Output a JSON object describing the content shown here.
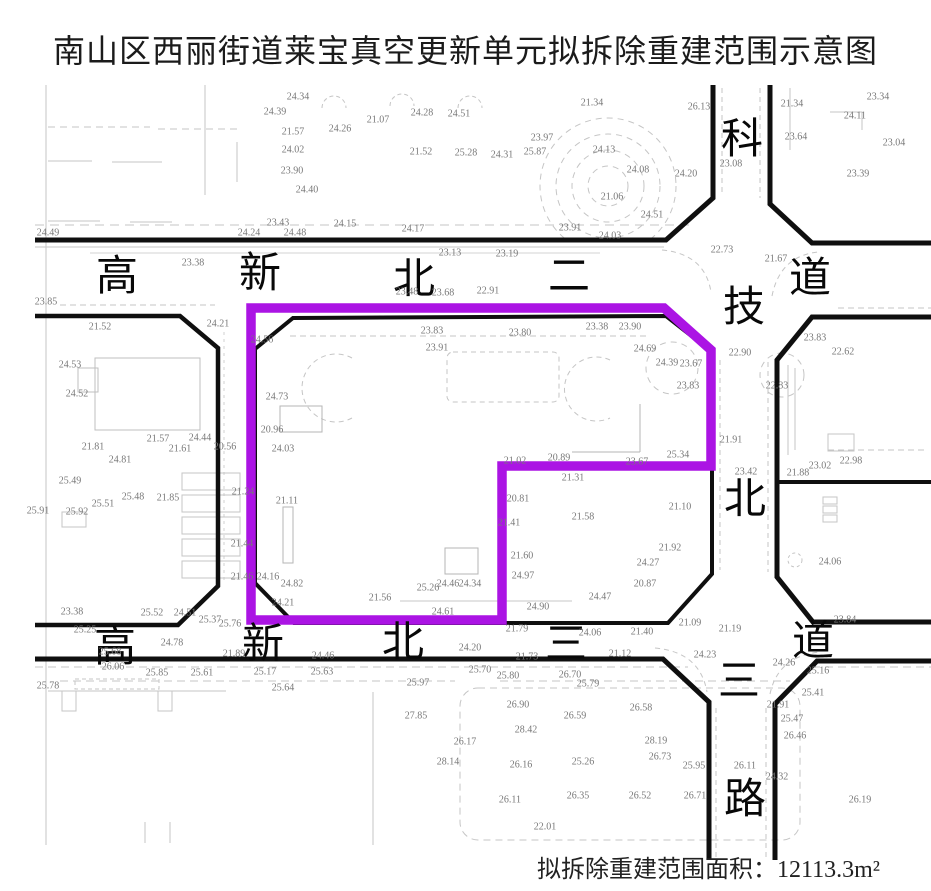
{
  "title": "南山区西丽街道莱宝真空更新单元拟拆除重建范围示意图",
  "footer": {
    "label": "拟拆除重建范围面积：",
    "value": "12113.3m²"
  },
  "colors": {
    "boundary": "#AB14E4",
    "road_line": "#0f0f0f",
    "detail_line": "#c5c5c5",
    "elevation_text": "#787878"
  },
  "roads": {
    "north_road": {
      "name": "高新北二道",
      "orientation": "horizontal",
      "chars": [
        {
          "c": "高",
          "x": 117,
          "y": 277
        },
        {
          "c": "新",
          "x": 260,
          "y": 274
        },
        {
          "c": "北",
          "x": 414,
          "y": 280
        },
        {
          "c": "二",
          "x": 569,
          "y": 277
        },
        {
          "c": "道",
          "x": 810,
          "y": 279
        }
      ]
    },
    "south_road": {
      "name": "高新北三道",
      "orientation": "horizontal",
      "chars": [
        {
          "c": "高",
          "x": 115,
          "y": 648
        },
        {
          "c": "新",
          "x": 263,
          "y": 645
        },
        {
          "c": "北",
          "x": 403,
          "y": 643
        },
        {
          "c": "三",
          "x": 566,
          "y": 645
        },
        {
          "c": "道",
          "x": 813,
          "y": 642
        }
      ]
    },
    "east_road": {
      "name": "科技北三路",
      "orientation": "vertical",
      "chars": [
        {
          "c": "科",
          "x": 742,
          "y": 140
        },
        {
          "c": "技",
          "x": 744,
          "y": 308
        },
        {
          "c": "北",
          "x": 745,
          "y": 500
        },
        {
          "c": "三",
          "x": 739,
          "y": 682
        },
        {
          "c": "路",
          "x": 745,
          "y": 800
        }
      ]
    }
  },
  "boundary": {
    "meaning": "拟拆除重建范围",
    "area": "12113.3m²"
  },
  "spot_elevations": [
    {
      "x": 48,
      "y": 233,
      "v": "24.49"
    },
    {
      "x": 249,
      "y": 233,
      "v": "24.24"
    },
    {
      "x": 295,
      "y": 233,
      "v": "24.48"
    },
    {
      "x": 413,
      "y": 229,
      "v": "24.17"
    },
    {
      "x": 345,
      "y": 224,
      "v": "24.15"
    },
    {
      "x": 278,
      "y": 223,
      "v": "23.43"
    },
    {
      "x": 298,
      "y": 97,
      "v": "24.34"
    },
    {
      "x": 275,
      "y": 112,
      "v": "24.39"
    },
    {
      "x": 422,
      "y": 113,
      "v": "24.28"
    },
    {
      "x": 459,
      "y": 114,
      "v": "24.51"
    },
    {
      "x": 378,
      "y": 120,
      "v": "21.07"
    },
    {
      "x": 293,
      "y": 132,
      "v": "21.57"
    },
    {
      "x": 340,
      "y": 129,
      "v": "24.26"
    },
    {
      "x": 293,
      "y": 150,
      "v": "24.02"
    },
    {
      "x": 421,
      "y": 152,
      "v": "21.52"
    },
    {
      "x": 466,
      "y": 153,
      "v": "25.28"
    },
    {
      "x": 292,
      "y": 171,
      "v": "23.90"
    },
    {
      "x": 307,
      "y": 190,
      "v": "24.40"
    },
    {
      "x": 592,
      "y": 103,
      "v": "21.34"
    },
    {
      "x": 542,
      "y": 138,
      "v": "23.97"
    },
    {
      "x": 502,
      "y": 155,
      "v": "24.31"
    },
    {
      "x": 535,
      "y": 152,
      "v": "25.87"
    },
    {
      "x": 604,
      "y": 150,
      "v": "24.13"
    },
    {
      "x": 638,
      "y": 170,
      "v": "24.08"
    },
    {
      "x": 686,
      "y": 174,
      "v": "24.20"
    },
    {
      "x": 612,
      "y": 197,
      "v": "21.06"
    },
    {
      "x": 652,
      "y": 215,
      "v": "24.51"
    },
    {
      "x": 570,
      "y": 228,
      "v": "23.91"
    },
    {
      "x": 610,
      "y": 236,
      "v": "24.03"
    },
    {
      "x": 699,
      "y": 107,
      "v": "26.13"
    },
    {
      "x": 792,
      "y": 104,
      "v": "21.34"
    },
    {
      "x": 855,
      "y": 116,
      "v": "24.11"
    },
    {
      "x": 858,
      "y": 174,
      "v": "23.39"
    },
    {
      "x": 878,
      "y": 97,
      "v": "23.34"
    },
    {
      "x": 894,
      "y": 143,
      "v": "23.04"
    },
    {
      "x": 796,
      "y": 137,
      "v": "23.64"
    },
    {
      "x": 731,
      "y": 164,
      "v": "23.08"
    },
    {
      "x": 193,
      "y": 263,
      "v": "23.38"
    },
    {
      "x": 450,
      "y": 253,
      "v": "23.13"
    },
    {
      "x": 507,
      "y": 254,
      "v": "23.19"
    },
    {
      "x": 722,
      "y": 250,
      "v": "22.73"
    },
    {
      "x": 407,
      "y": 292,
      "v": "23.48"
    },
    {
      "x": 443,
      "y": 293,
      "v": "23.68"
    },
    {
      "x": 488,
      "y": 291,
      "v": "22.91"
    },
    {
      "x": 46,
      "y": 302,
      "v": "23.85"
    },
    {
      "x": 776,
      "y": 259,
      "v": "21.67"
    },
    {
      "x": 843,
      "y": 352,
      "v": "22.62"
    },
    {
      "x": 815,
      "y": 338,
      "v": "23.83"
    },
    {
      "x": 740,
      "y": 353,
      "v": "22.90"
    },
    {
      "x": 777,
      "y": 386,
      "v": "22.83"
    },
    {
      "x": 851,
      "y": 461,
      "v": "22.98"
    },
    {
      "x": 820,
      "y": 466,
      "v": "23.02"
    },
    {
      "x": 798,
      "y": 473,
      "v": "21.88"
    },
    {
      "x": 731,
      "y": 440,
      "v": "21.91"
    },
    {
      "x": 746,
      "y": 472,
      "v": "23.42"
    },
    {
      "x": 830,
      "y": 562,
      "v": "24.06"
    },
    {
      "x": 845,
      "y": 620,
      "v": "23.84"
    },
    {
      "x": 100,
      "y": 327,
      "v": "21.52"
    },
    {
      "x": 218,
      "y": 324,
      "v": "24.21"
    },
    {
      "x": 262,
      "y": 340,
      "v": "24.56"
    },
    {
      "x": 432,
      "y": 331,
      "v": "23.83"
    },
    {
      "x": 437,
      "y": 348,
      "v": "23.91"
    },
    {
      "x": 520,
      "y": 333,
      "v": "23.80"
    },
    {
      "x": 597,
      "y": 327,
      "v": "23.38"
    },
    {
      "x": 630,
      "y": 327,
      "v": "23.90"
    },
    {
      "x": 645,
      "y": 349,
      "v": "24.69"
    },
    {
      "x": 667,
      "y": 363,
      "v": "24.39"
    },
    {
      "x": 691,
      "y": 364,
      "v": "23.67"
    },
    {
      "x": 688,
      "y": 386,
      "v": "23.83"
    },
    {
      "x": 277,
      "y": 397,
      "v": "24.73"
    },
    {
      "x": 272,
      "y": 430,
      "v": "20.96"
    },
    {
      "x": 283,
      "y": 449,
      "v": "24.03"
    },
    {
      "x": 70,
      "y": 365,
      "v": "24.53"
    },
    {
      "x": 77,
      "y": 394,
      "v": "24.52"
    },
    {
      "x": 515,
      "y": 461,
      "v": "21.02"
    },
    {
      "x": 559,
      "y": 458,
      "v": "20.89"
    },
    {
      "x": 573,
      "y": 478,
      "v": "21.31"
    },
    {
      "x": 637,
      "y": 462,
      "v": "23.67"
    },
    {
      "x": 678,
      "y": 455,
      "v": "25.34"
    },
    {
      "x": 509,
      "y": 523,
      "v": "21.41"
    },
    {
      "x": 518,
      "y": 499,
      "v": "20.81"
    },
    {
      "x": 583,
      "y": 517,
      "v": "21.58"
    },
    {
      "x": 680,
      "y": 507,
      "v": "21.10"
    },
    {
      "x": 670,
      "y": 548,
      "v": "21.92"
    },
    {
      "x": 648,
      "y": 563,
      "v": "24.27"
    },
    {
      "x": 645,
      "y": 584,
      "v": "20.87"
    },
    {
      "x": 523,
      "y": 576,
      "v": "24.97"
    },
    {
      "x": 522,
      "y": 556,
      "v": "21.60"
    },
    {
      "x": 600,
      "y": 597,
      "v": "24.47"
    },
    {
      "x": 538,
      "y": 607,
      "v": "24.90"
    },
    {
      "x": 470,
      "y": 584,
      "v": "24.34"
    },
    {
      "x": 380,
      "y": 598,
      "v": "21.56"
    },
    {
      "x": 428,
      "y": 588,
      "v": "25.26"
    },
    {
      "x": 448,
      "y": 584,
      "v": "24.46"
    },
    {
      "x": 443,
      "y": 612,
      "v": "24.61"
    },
    {
      "x": 292,
      "y": 584,
      "v": "24.82"
    },
    {
      "x": 268,
      "y": 577,
      "v": "24.16"
    },
    {
      "x": 283,
      "y": 603,
      "v": "24.21"
    },
    {
      "x": 287,
      "y": 501,
      "v": "21.11"
    },
    {
      "x": 243,
      "y": 492,
      "v": "21.24"
    },
    {
      "x": 242,
      "y": 544,
      "v": "21.44"
    },
    {
      "x": 242,
      "y": 577,
      "v": "21.46"
    },
    {
      "x": 690,
      "y": 623,
      "v": "21.09"
    },
    {
      "x": 70,
      "y": 481,
      "v": "25.49"
    },
    {
      "x": 133,
      "y": 497,
      "v": "25.48"
    },
    {
      "x": 103,
      "y": 504,
      "v": "25.51"
    },
    {
      "x": 168,
      "y": 498,
      "v": "21.85"
    },
    {
      "x": 38,
      "y": 511,
      "v": "25.91"
    },
    {
      "x": 77,
      "y": 512,
      "v": "25.92"
    },
    {
      "x": 158,
      "y": 439,
      "v": "21.57"
    },
    {
      "x": 200,
      "y": 438,
      "v": "24.44"
    },
    {
      "x": 93,
      "y": 447,
      "v": "21.81"
    },
    {
      "x": 120,
      "y": 460,
      "v": "24.81"
    },
    {
      "x": 180,
      "y": 449,
      "v": "21.61"
    },
    {
      "x": 225,
      "y": 447,
      "v": "20.56"
    },
    {
      "x": 72,
      "y": 612,
      "v": "23.38"
    },
    {
      "x": 152,
      "y": 613,
      "v": "25.52"
    },
    {
      "x": 185,
      "y": 613,
      "v": "24.51"
    },
    {
      "x": 210,
      "y": 620,
      "v": "25.37"
    },
    {
      "x": 230,
      "y": 624,
      "v": "25.76"
    },
    {
      "x": 85,
      "y": 630,
      "v": "25.25"
    },
    {
      "x": 172,
      "y": 643,
      "v": "24.78"
    },
    {
      "x": 110,
      "y": 652,
      "v": "25.68"
    },
    {
      "x": 234,
      "y": 654,
      "v": "21.89"
    },
    {
      "x": 323,
      "y": 656,
      "v": "24.46"
    },
    {
      "x": 470,
      "y": 648,
      "v": "24.20"
    },
    {
      "x": 527,
      "y": 657,
      "v": "21.73"
    },
    {
      "x": 517,
      "y": 629,
      "v": "21.79"
    },
    {
      "x": 590,
      "y": 633,
      "v": "24.06"
    },
    {
      "x": 642,
      "y": 632,
      "v": "21.40"
    },
    {
      "x": 620,
      "y": 654,
      "v": "21.12"
    },
    {
      "x": 705,
      "y": 655,
      "v": "24.23"
    },
    {
      "x": 730,
      "y": 629,
      "v": "21.19"
    },
    {
      "x": 784,
      "y": 663,
      "v": "24.26"
    },
    {
      "x": 113,
      "y": 667,
      "v": "26.06"
    },
    {
      "x": 157,
      "y": 673,
      "v": "25.85"
    },
    {
      "x": 202,
      "y": 673,
      "v": "25.61"
    },
    {
      "x": 265,
      "y": 672,
      "v": "25.17"
    },
    {
      "x": 322,
      "y": 672,
      "v": "25.63"
    },
    {
      "x": 283,
      "y": 688,
      "v": "25.64"
    },
    {
      "x": 48,
      "y": 686,
      "v": "25.78"
    },
    {
      "x": 418,
      "y": 683,
      "v": "25.97"
    },
    {
      "x": 480,
      "y": 670,
      "v": "25.70"
    },
    {
      "x": 508,
      "y": 676,
      "v": "25.80"
    },
    {
      "x": 570,
      "y": 675,
      "v": "26.70"
    },
    {
      "x": 588,
      "y": 684,
      "v": "25.79"
    },
    {
      "x": 518,
      "y": 705,
      "v": "26.90"
    },
    {
      "x": 641,
      "y": 708,
      "v": "26.58"
    },
    {
      "x": 575,
      "y": 716,
      "v": "26.59"
    },
    {
      "x": 416,
      "y": 716,
      "v": "27.85"
    },
    {
      "x": 526,
      "y": 730,
      "v": "28.42"
    },
    {
      "x": 465,
      "y": 742,
      "v": "26.17"
    },
    {
      "x": 656,
      "y": 741,
      "v": "28.19"
    },
    {
      "x": 660,
      "y": 757,
      "v": "26.73"
    },
    {
      "x": 448,
      "y": 762,
      "v": "28.14"
    },
    {
      "x": 521,
      "y": 765,
      "v": "26.16"
    },
    {
      "x": 583,
      "y": 762,
      "v": "25.26"
    },
    {
      "x": 510,
      "y": 800,
      "v": "26.11"
    },
    {
      "x": 578,
      "y": 796,
      "v": "26.35"
    },
    {
      "x": 640,
      "y": 796,
      "v": "26.52"
    },
    {
      "x": 545,
      "y": 827,
      "v": "22.01"
    },
    {
      "x": 694,
      "y": 766,
      "v": "25.95"
    },
    {
      "x": 695,
      "y": 796,
      "v": "26.71"
    },
    {
      "x": 818,
      "y": 671,
      "v": "25.16"
    },
    {
      "x": 813,
      "y": 693,
      "v": "25.41"
    },
    {
      "x": 778,
      "y": 705,
      "v": "21.91"
    },
    {
      "x": 792,
      "y": 719,
      "v": "25.47"
    },
    {
      "x": 795,
      "y": 736,
      "v": "26.46"
    },
    {
      "x": 745,
      "y": 766,
      "v": "26.11"
    },
    {
      "x": 777,
      "y": 777,
      "v": "24.32"
    },
    {
      "x": 860,
      "y": 800,
      "v": "26.19"
    }
  ]
}
